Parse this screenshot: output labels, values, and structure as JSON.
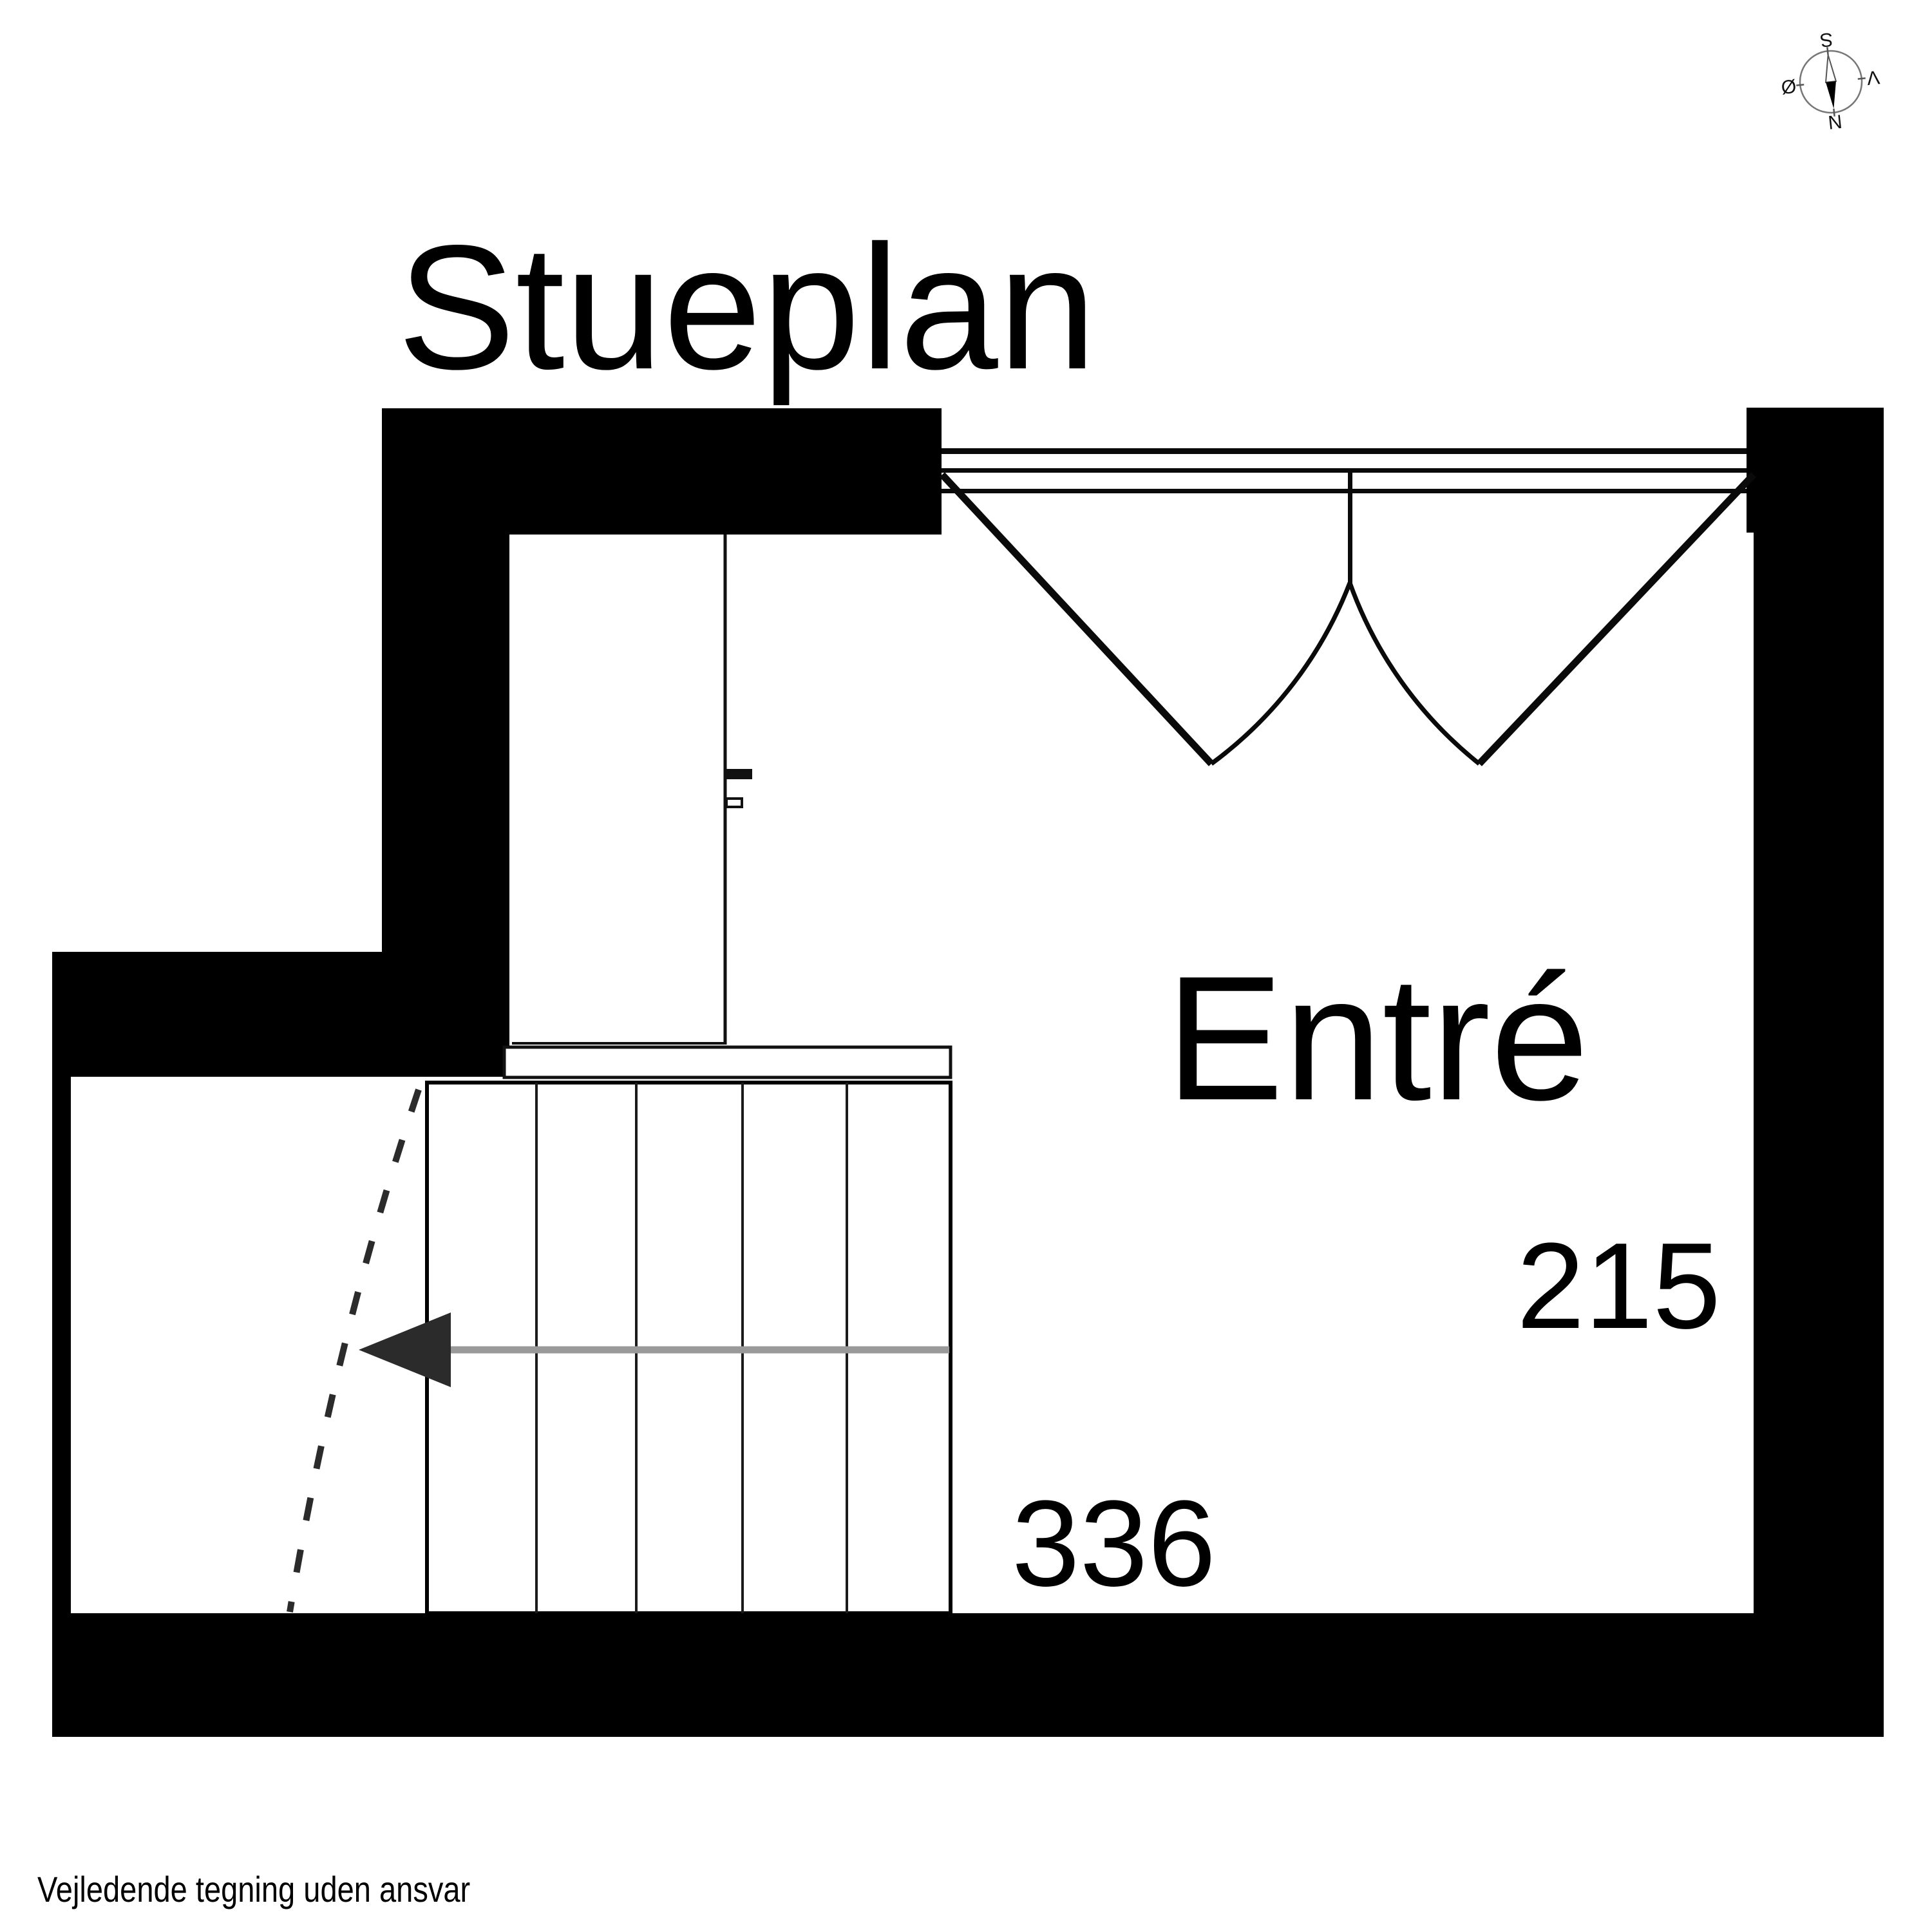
{
  "title": "Stueplan",
  "rooms": [
    {
      "name": "Entré",
      "width_label": "336",
      "height_label": "215"
    }
  ],
  "stair": {
    "direction": "down-left",
    "treads": 5
  },
  "footer": {
    "disclaimer": "Vejledende tegning uden ansvar"
  },
  "compass": {
    "north_label": "N",
    "south_label": "S",
    "east_label": "Ø",
    "west_label": "V",
    "rotation_deg": 174
  },
  "colors": {
    "wall": "#000000",
    "door_line": "#0a0a0a",
    "stair_line": "#1a1a1a",
    "guide_line": "#999999",
    "dash_line": "#2b2b2b",
    "compass_ring": "#777777",
    "text": "#000000",
    "background": "#ffffff"
  }
}
